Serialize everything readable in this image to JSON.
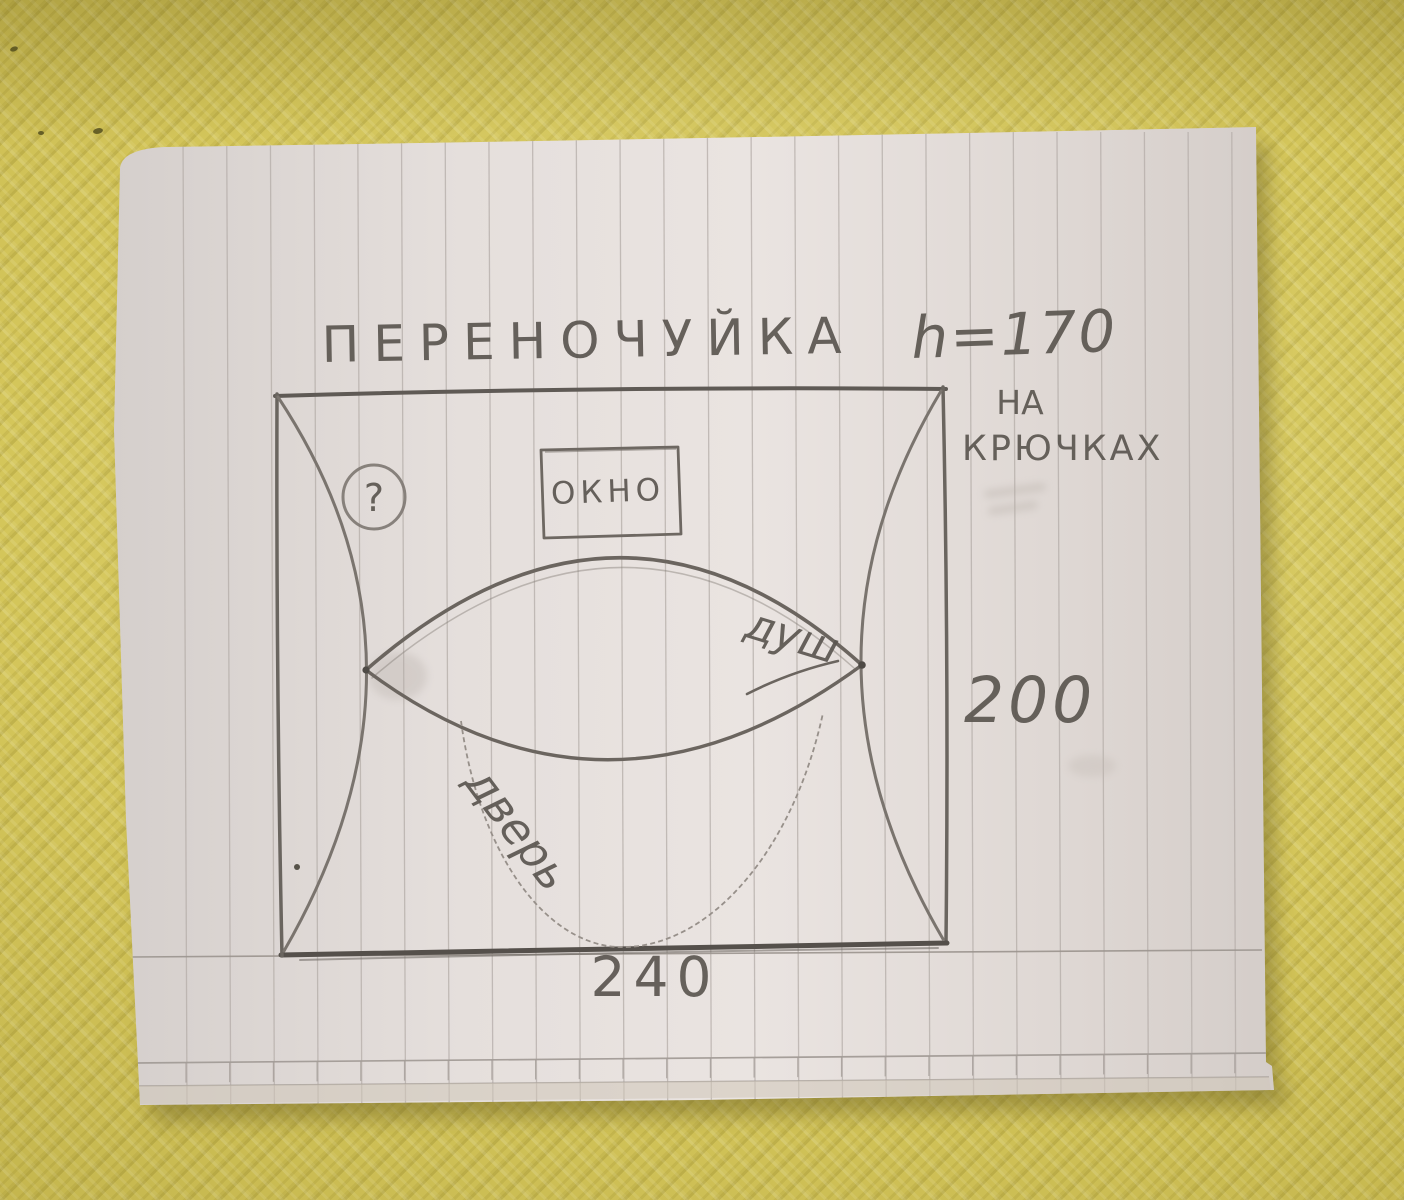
{
  "sketch": {
    "title": "ПЕРЕНОЧУЙКА",
    "height_note": "h=170",
    "hooks_note": {
      "line1": "НА",
      "line2": "КРЮЧКАХ"
    },
    "window_label": "ОКНО",
    "question_mark": "?",
    "shower_label": "душ",
    "door_label": "дверь",
    "width_dimension": "240",
    "height_dimension": "200"
  },
  "colors": {
    "mat_yellow": "#d2c355",
    "paper": "#e6e0dd",
    "pencil": "#6e6962",
    "rule_line": "#b4ada8"
  }
}
